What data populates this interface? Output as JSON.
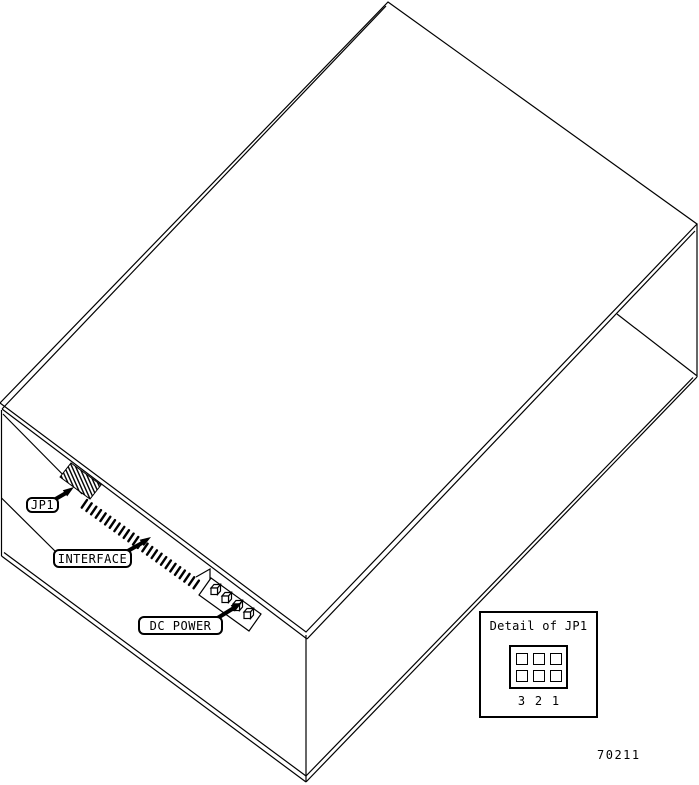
{
  "figure": {
    "colors": {
      "line": "#000000",
      "background": "#ffffff"
    },
    "labels": {
      "jp1": "JP1",
      "interface": "INTERFACE",
      "dc_power": "DC POWER"
    },
    "detail_box": {
      "title": "Detail of JP1",
      "pin_numbers": [
        "3",
        "2",
        "1"
      ]
    },
    "figure_number": "70211"
  }
}
